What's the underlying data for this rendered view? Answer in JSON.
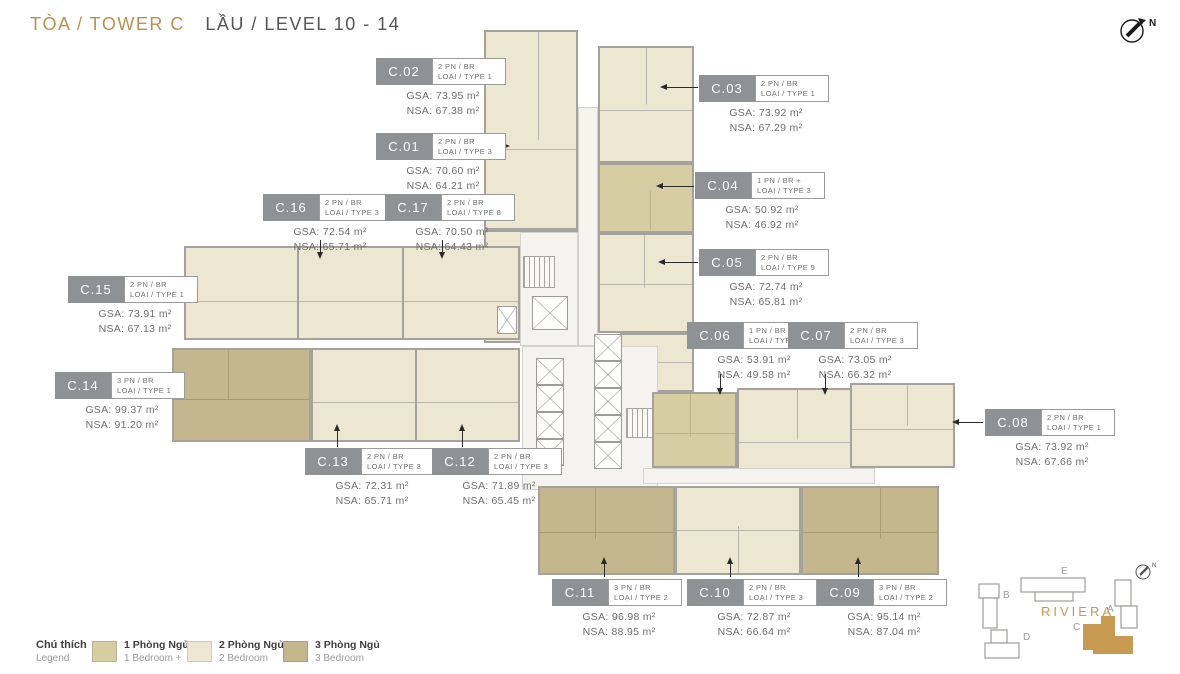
{
  "header": {
    "tower": "TÒA / TOWER C",
    "level": "LẦU / LEVEL 10 - 14"
  },
  "compass": {
    "label": "N"
  },
  "units": [
    {
      "id": "C.01",
      "type1": "2 PN / BR",
      "type2": "LOẠI / TYPE 3",
      "gsa": "GSA: 70.60 m²",
      "nsa": "NSA: 64.21 m²"
    },
    {
      "id": "C.02",
      "type1": "2 PN / BR",
      "type2": "LOẠI / TYPE 1",
      "gsa": "GSA: 73.95 m²",
      "nsa": "NSA: 67.38 m²"
    },
    {
      "id": "C.03",
      "type1": "2 PN / BR",
      "type2": "LOẠI / TYPE 1",
      "gsa": "GSA: 73.92 m²",
      "nsa": "NSA: 67.29 m²"
    },
    {
      "id": "C.04",
      "type1": "1 PN / BR +",
      "type2": "LOẠI / TYPE 3",
      "gsa": "GSA: 50.92 m²",
      "nsa": "NSA: 46.92 m²"
    },
    {
      "id": "C.05",
      "type1": "2 PN / BR",
      "type2": "LOẠI / TYPE 9",
      "gsa": "GSA: 72.74 m²",
      "nsa": "NSA: 65.81 m²"
    },
    {
      "id": "C.06",
      "type1": "1 PN / BR +",
      "type2": "LOẠI / TYPE 3",
      "gsa": "GSA: 53.91 m²",
      "nsa": "NSA: 49.58 m²"
    },
    {
      "id": "C.07",
      "type1": "2 PN / BR",
      "type2": "LOẠI / TYPE 3",
      "gsa": "GSA: 73.05 m²",
      "nsa": "NSA: 66.32 m²"
    },
    {
      "id": "C.08",
      "type1": "2 PN / BR",
      "type2": "LOẠI / TYPE 1",
      "gsa": "GSA: 73.92 m²",
      "nsa": "NSA: 67.66 m²"
    },
    {
      "id": "C.09",
      "type1": "3 PN / BR",
      "type2": "LOẠI / TYPE 2",
      "gsa": "GSA: 95.14 m²",
      "nsa": "NSA: 87.04 m²"
    },
    {
      "id": "C.10",
      "type1": "2 PN / BR",
      "type2": "LOẠI / TYPE 3",
      "gsa": "GSA: 72.87 m²",
      "nsa": "NSA: 66.64 m²"
    },
    {
      "id": "C.11",
      "type1": "3 PN / BR",
      "type2": "LOẠI / TYPE 2",
      "gsa": "GSA: 96.98 m²",
      "nsa": "NSA: 88.95 m²"
    },
    {
      "id": "C.12",
      "type1": "2 PN / BR",
      "type2": "LOẠI / TYPE 3",
      "gsa": "GSA: 71.89 m²",
      "nsa": "NSA: 65.45 m²"
    },
    {
      "id": "C.13",
      "type1": "2 PN / BR",
      "type2": "LOẠI / TYPE 3",
      "gsa": "GSA: 72.31 m²",
      "nsa": "NSA: 65.71 m²"
    },
    {
      "id": "C.14",
      "type1": "3 PN / BR",
      "type2": "LOẠI / TYPE 1",
      "gsa": "GSA: 99.37 m²",
      "nsa": "NSA: 91.20 m²"
    },
    {
      "id": "C.15",
      "type1": "2 PN / BR",
      "type2": "LOẠI / TYPE 1",
      "gsa": "GSA: 73.91 m²",
      "nsa": "NSA: 67.13 m²"
    },
    {
      "id": "C.16",
      "type1": "2 PN / BR",
      "type2": "LOẠI / TYPE 3",
      "gsa": "GSA: 72.54 m²",
      "nsa": "NSA: 65.71 m²"
    },
    {
      "id": "C.17",
      "type1": "2 PN / BR",
      "type2": "LOẠI / TYPE 8",
      "gsa": "GSA: 70.50 m²",
      "nsa": "NSA: 64.43 m²"
    }
  ],
  "legend": {
    "title_vi": "Chú thích",
    "title_en": "Legend",
    "items": [
      {
        "vi": "1 Phòng Ngủ +",
        "en": "1 Bedroom +",
        "color": "#D7CDA3"
      },
      {
        "vi": "2 Phòng Ngủ",
        "en": "2 Bedroom",
        "color": "#EDE6D1"
      },
      {
        "vi": "3 Phòng Ngủ",
        "en": "3 Bedroom",
        "color": "#C4B68D"
      }
    ]
  },
  "sitemap": {
    "name": "RIVIERA",
    "buildings": {
      "a": "A",
      "b": "B",
      "c": "C",
      "d": "D",
      "e": "E"
    },
    "highlighted": "C",
    "compass_label": "N"
  },
  "colors": {
    "accent_gold": "#BD8F4F",
    "bedroom1_plus": "#D7CDA3",
    "bedroom2": "#EDE6D1",
    "bedroom3": "#C4B68D",
    "wall": "#A3A29D",
    "label_box": "#8F9294",
    "text_gray": "#6D6E70"
  }
}
